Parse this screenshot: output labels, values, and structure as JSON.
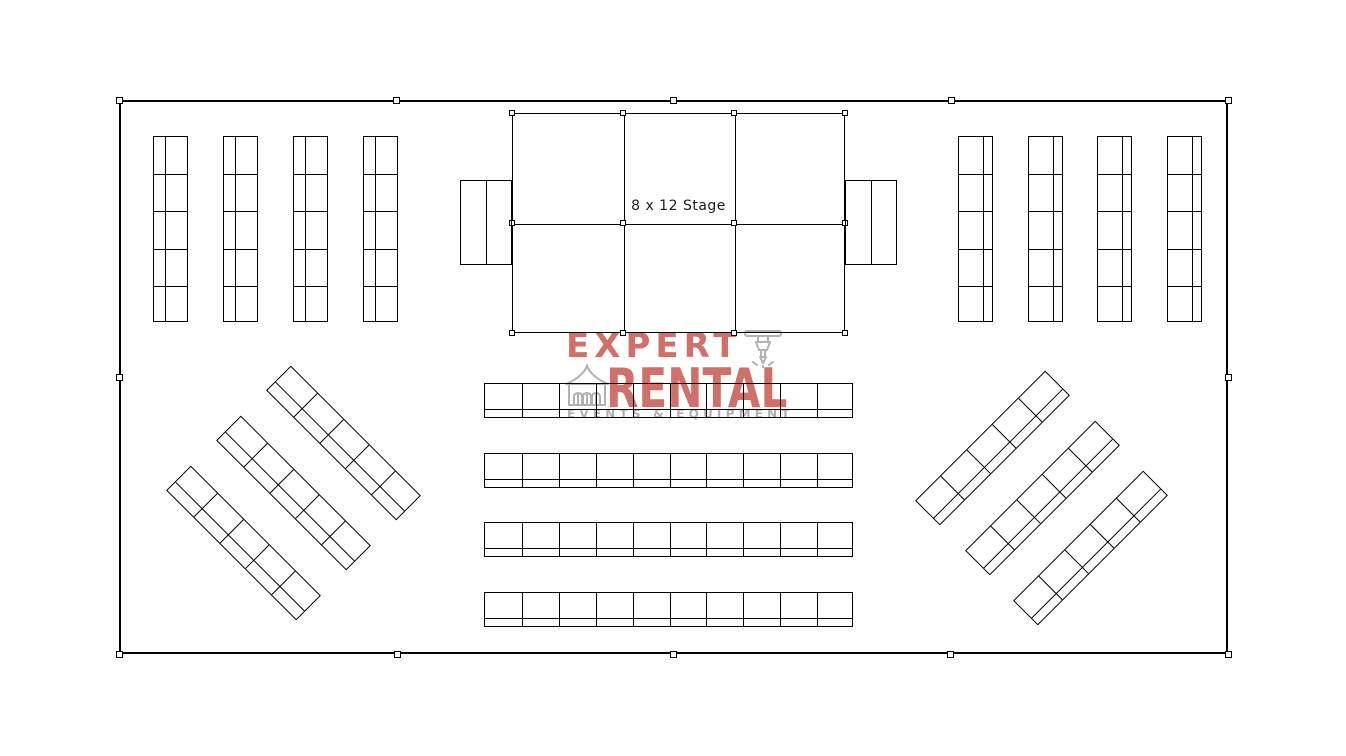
{
  "page": {
    "background": "#ffffff",
    "line_color": "#000000",
    "width": 1346,
    "height": 756
  },
  "logo": {
    "word1": "EXPERT",
    "word2": "RENTAL",
    "subline": "EVENTS & EQUIPMENT",
    "accent_color": "#cf7169",
    "gray_color": "#b1b1b1",
    "icons": [
      "tent-icon",
      "jackhammer-icon"
    ]
  },
  "floor_plan": {
    "tent": {
      "x": 119,
      "y": 100,
      "w": 1109,
      "h": 554
    },
    "pole_markers": [
      [
        119,
        100
      ],
      [
        396,
        100
      ],
      [
        673,
        100
      ],
      [
        951,
        100
      ],
      [
        1228,
        100
      ],
      [
        119,
        377
      ],
      [
        1228,
        377
      ],
      [
        119,
        654
      ],
      [
        397,
        654
      ],
      [
        673,
        654
      ],
      [
        950,
        654
      ],
      [
        1228,
        654
      ]
    ],
    "stage": {
      "label": "8 x 12 Stage",
      "x": 512,
      "y": 113,
      "w": 333,
      "h": 220,
      "cols": 3,
      "rows": 2
    },
    "stage_steps": [
      {
        "x": 460,
        "y": 180,
        "w": 52,
        "h": 85,
        "divider": 25
      },
      {
        "x": 845,
        "y": 180,
        "w": 52,
        "h": 85,
        "divider": 25
      }
    ],
    "banquet_tables": [
      {
        "id": "left-column",
        "type": "vertical",
        "w": 35,
        "h": 186,
        "segments": 5,
        "strip": 11,
        "items": [
          [
            153,
            136
          ],
          [
            223,
            136
          ],
          [
            293,
            136
          ],
          [
            363,
            136
          ]
        ]
      },
      {
        "id": "right-column",
        "type": "vertical",
        "w": 35,
        "h": 186,
        "segments": 5,
        "strip": 24,
        "items": [
          [
            958,
            136
          ],
          [
            1028,
            136
          ],
          [
            1097,
            136
          ],
          [
            1167,
            136
          ]
        ]
      },
      {
        "id": "center-row",
        "type": "horizontal",
        "w": 369,
        "h": 35,
        "segments": 10,
        "strip": 25,
        "items": [
          [
            484,
            383
          ],
          [
            484,
            453
          ],
          [
            484,
            522
          ],
          [
            484,
            592
          ]
        ]
      },
      {
        "id": "diagonal-left",
        "type": "vertical",
        "w": 35,
        "h": 184,
        "segments": 5,
        "strip": 11,
        "rotate": -45,
        "center": true,
        "items": [
          [
            343.5,
            442.5
          ],
          [
            293.5,
            492.5
          ],
          [
            243.5,
            542.5
          ]
        ]
      },
      {
        "id": "diagonal-right",
        "type": "vertical",
        "w": 35,
        "h": 184,
        "segments": 5,
        "strip": 24,
        "rotate": 45,
        "center": true,
        "items": [
          [
            992.5,
            447.5
          ],
          [
            1042.5,
            497.5
          ],
          [
            1090.5,
            547.5
          ]
        ]
      }
    ]
  }
}
